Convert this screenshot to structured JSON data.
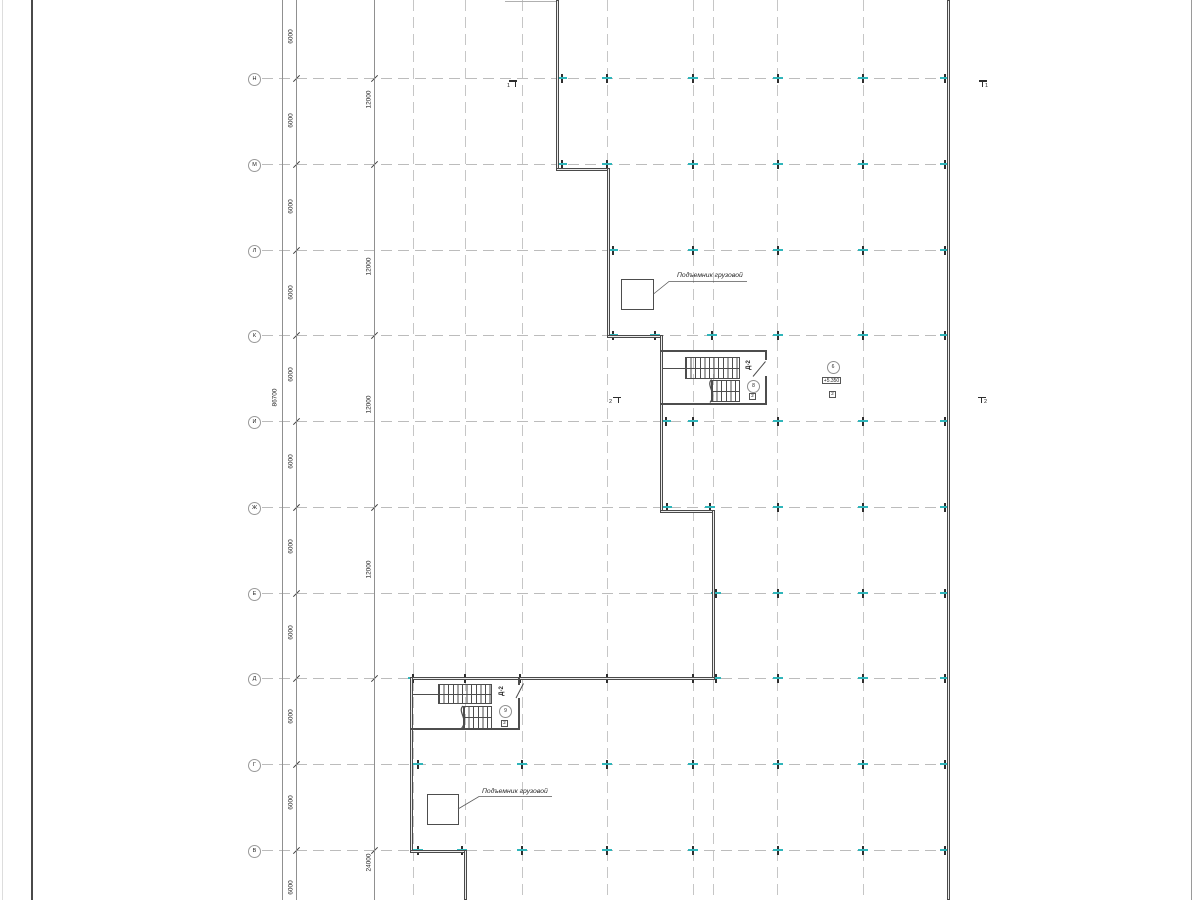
{
  "axes": {
    "rows": [
      {
        "label": "Н"
      },
      {
        "label": "М"
      },
      {
        "label": "Л"
      },
      {
        "label": "К"
      },
      {
        "label": "И"
      },
      {
        "label": "Ж"
      },
      {
        "label": "Е"
      },
      {
        "label": "Д"
      },
      {
        "label": "Г"
      },
      {
        "label": "В"
      }
    ]
  },
  "dimensions": {
    "bay": "6000",
    "double_bay": "12000",
    "quad_bay": "24000",
    "total": "86700"
  },
  "annotations": {
    "cargo_lift": "Подъемник грузовой"
  },
  "stairs": {
    "label": "Д-2",
    "upper": {
      "number": "8",
      "tag": "2"
    },
    "lower": {
      "number": "9",
      "tag": "2"
    }
  },
  "node": {
    "number": "6",
    "elevation": "+5.350",
    "tag": "2"
  },
  "sections": {
    "one": "1",
    "two": "2"
  },
  "colors": {
    "grid": "#bcbcbc",
    "wall": "#4d4d4d",
    "tick_accent": "#2fb5ba",
    "dim_line": "#909090",
    "text": "#262626"
  }
}
